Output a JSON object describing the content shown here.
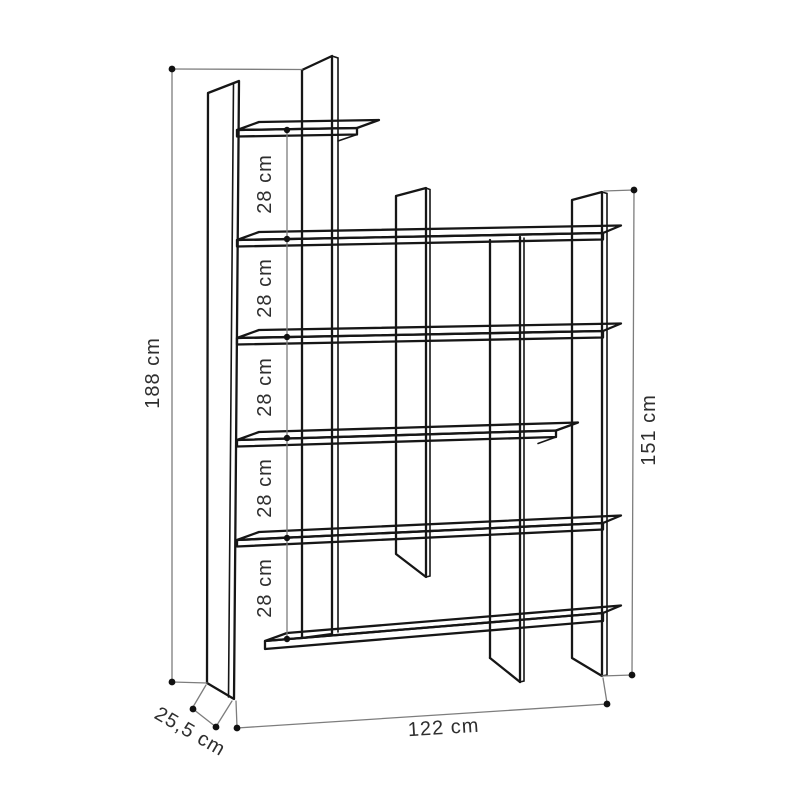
{
  "diagram": {
    "type": "furniture-dimension-drawing",
    "subject": "asymmetric bookcase line drawing with dimension annotations",
    "unit": "cm",
    "labels": {
      "total_height": "188 cm",
      "right_section_height": "151 cm",
      "width": "122 cm",
      "depth": "25,5 cm",
      "shelf_gaps": [
        "28 cm",
        "28 cm",
        "28 cm",
        "28 cm",
        "28 cm"
      ]
    }
  }
}
